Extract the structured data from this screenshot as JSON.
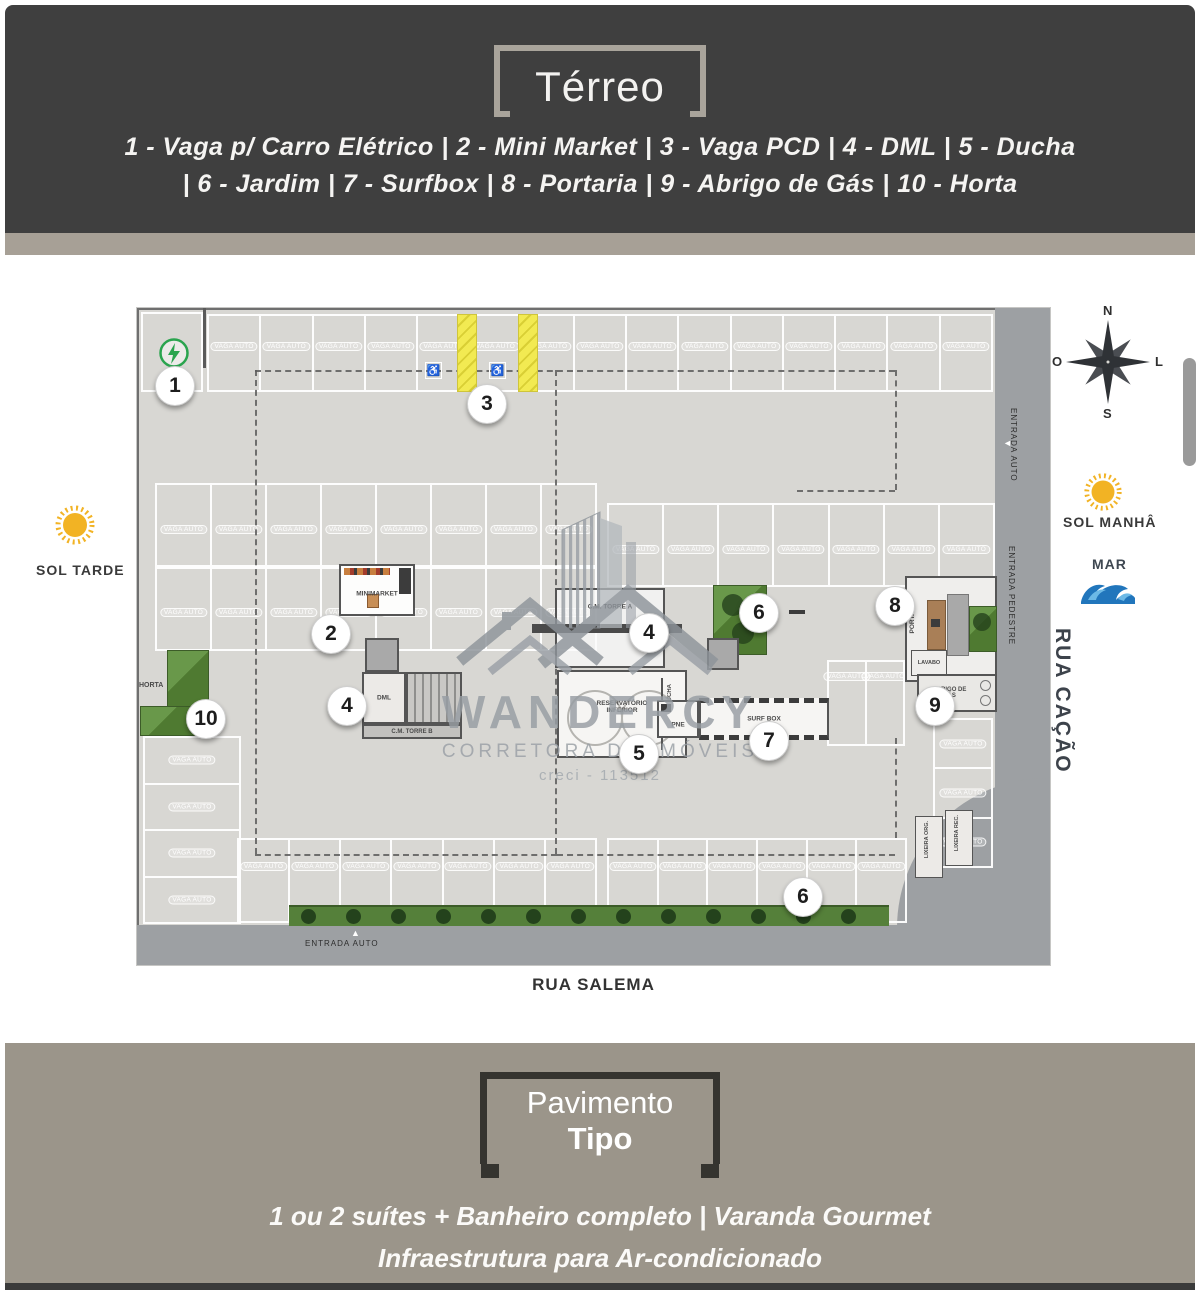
{
  "header": {
    "title": "Térreo",
    "legend_line1": "1 - Vaga p/ Carro Elétrico  |  2 - Mini Market   |   3 - Vaga PCD   |  4 - DML  |  5 - Ducha",
    "legend_line2": "|  6 - Jardim  |  7 - Surfbox |  8 - Portaria  |   9 - Abrigo de Gás  |  10 - Horta"
  },
  "footer": {
    "title_line1": "Pavimento",
    "title_line2": "Tipo",
    "text_line1": "1 ou 2 suítes + Banheiro completo  |  Varanda Gourmet",
    "text_line2": "Infraestrutura para Ar-condicionado"
  },
  "sides": {
    "sun_afternoon": "SOL TARDE",
    "sun_morning": "SOL MANHÂ",
    "sea": "MAR",
    "compass": {
      "n": "N",
      "s": "S",
      "e": "L",
      "w": "O"
    }
  },
  "watermark": {
    "name": "WANDERCY",
    "subtitle": "CORRETORA DE IMÓVEIS",
    "creci": "creci - 113512"
  },
  "plan": {
    "stall_label": "VAGA AUTO",
    "streets": {
      "bottom": "RUA SALEMA",
      "right": "RUA CAÇÃO",
      "entrance_auto_bottom": "ENTRADA AUTO",
      "entrance_auto_right": "ENTRADA AUTO",
      "entrance_pedestrian": "ENTRADA PEDESTRE"
    },
    "rooms": {
      "minimarket": "MINIMARKET",
      "dml_left": "DML",
      "cm_torre_b": "C.M. TORRE B",
      "cm_torre_a": "C.M. TORRE A",
      "dml_center": "DML",
      "reservatorio_l1": "RESERVATÓRIO",
      "reservatorio_l2": "INFERIOR",
      "ducha": "DUCHA",
      "pne": "PNE",
      "surfbox": "SURF BOX",
      "portaria": "PORTARIA",
      "lavabo": "LAVABO",
      "abrigo_l1": "ABRIGO DE",
      "abrigo_l2": "GÁS",
      "lixeira_org": "LIXEIRA ORG.",
      "lixeira_rec": "LIXEIRA REC.",
      "horta": "HORTA"
    },
    "parking_rows": [
      {
        "x": 70,
        "y": 6,
        "w": 786,
        "h": 78,
        "count": 15,
        "dir": "cols",
        "labelTop": 26
      },
      {
        "x": 18,
        "y": 175,
        "w": 442,
        "h": 84,
        "count": 8,
        "dir": "cols",
        "labelTop": 40
      },
      {
        "x": 18,
        "y": 259,
        "w": 442,
        "h": 84,
        "count": 8,
        "dir": "cols",
        "labelTop": 39
      },
      {
        "x": 470,
        "y": 195,
        "w": 388,
        "h": 84,
        "count": 7,
        "dir": "cols",
        "labelTop": 40
      },
      {
        "x": 690,
        "y": 352,
        "w": 78,
        "h": 86,
        "count": 2,
        "dir": "cols",
        "labelTop": 10
      },
      {
        "x": 100,
        "y": 530,
        "w": 360,
        "h": 85,
        "count": 7,
        "dir": "cols",
        "labelTop": 22
      },
      {
        "x": 470,
        "y": 530,
        "w": 300,
        "h": 85,
        "count": 6,
        "dir": "cols",
        "labelTop": 22
      },
      {
        "x": 6,
        "y": 428,
        "w": 98,
        "h": 188,
        "count": 4,
        "dir": "rows"
      },
      {
        "x": 796,
        "y": 410,
        "w": 60,
        "h": 150,
        "count": 3,
        "dir": "rows"
      }
    ],
    "aisle_dashes": [
      {
        "x": 118,
        "y": 62,
        "w": 640,
        "h": 0
      },
      {
        "x": 118,
        "y": 62,
        "w": 0,
        "h": 484
      },
      {
        "x": 118,
        "y": 546,
        "w": 302,
        "h": 0
      },
      {
        "x": 418,
        "y": 62,
        "w": 0,
        "h": 484
      },
      {
        "x": 420,
        "y": 546,
        "w": 338,
        "h": 0
      },
      {
        "x": 758,
        "y": 62,
        "w": 0,
        "h": 120
      },
      {
        "x": 660,
        "y": 182,
        "w": 98,
        "h": 0
      },
      {
        "x": 758,
        "y": 430,
        "w": 0,
        "h": 100
      }
    ],
    "markers": [
      {
        "n": "1",
        "x": 38,
        "y": 78
      },
      {
        "n": "2",
        "x": 194,
        "y": 326
      },
      {
        "n": "3",
        "x": 350,
        "y": 96
      },
      {
        "n": "4",
        "x": 210,
        "y": 398
      },
      {
        "n": "4",
        "x": 512,
        "y": 325
      },
      {
        "n": "5",
        "x": 502,
        "y": 446
      },
      {
        "n": "6",
        "x": 622,
        "y": 305
      },
      {
        "n": "6",
        "x": 666,
        "y": 589
      },
      {
        "n": "7",
        "x": 632,
        "y": 433
      },
      {
        "n": "8",
        "x": 758,
        "y": 298
      },
      {
        "n": "9",
        "x": 798,
        "y": 398
      },
      {
        "n": "10",
        "x": 69,
        "y": 411
      }
    ],
    "hedge_tree_count": 13
  },
  "colors": {
    "header_bg": "#3f3f3f",
    "band": "#a7a096",
    "footer_bg": "#9b958a",
    "plan_bg": "#d8d7d3",
    "road": "#9da0a3",
    "accent_green": "#2aa44e",
    "hedge_green": "#55803a",
    "pcd_yellow": "#f2ea52",
    "watermark_gray": "#979da3"
  }
}
